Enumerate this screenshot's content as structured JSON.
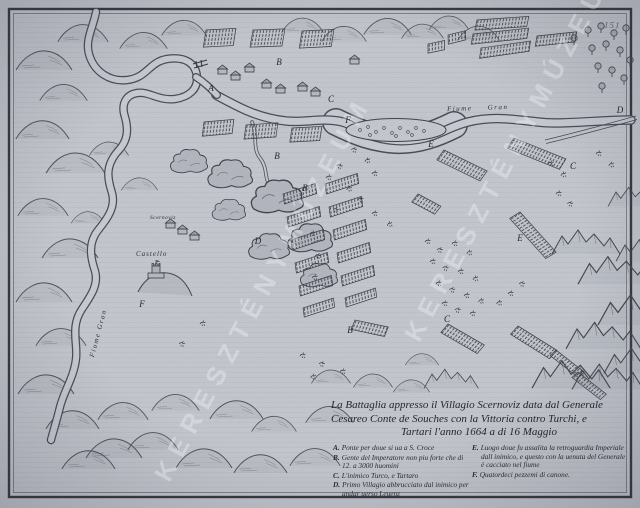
{
  "artifact": {
    "page_number": "151",
    "watermark_text": "KERESZTÉNYMÚZEUM"
  },
  "colors": {
    "paper": "#c2c6cd",
    "ink": "#3a3a42",
    "water": "#c9ccd4",
    "smoke": "#b4b7c0"
  },
  "title": {
    "line1": "La Battaglia appresso il Villagio Scernoviz data dal Generale",
    "line2": "Cesareo Conte de Souches con la Vittoria contro Turchi, e",
    "line3": "Tartari l'anno 1664 a di 16 Maggio"
  },
  "legend": {
    "left": [
      {
        "key": "A.",
        "text": "Ponte per doue si ua a S. Croce"
      },
      {
        "key": "B.",
        "text": "Gente del Imperatore non piu forte che di 12. a 3000 huomini"
      },
      {
        "key": "C.",
        "text": "L'inimico Turco, e Tartaro"
      },
      {
        "key": "D.",
        "text": "Primo Villagio abbrucciato dal inimico per andar uerso Leuenz"
      }
    ],
    "right": [
      {
        "key": "E.",
        "text": "Luogo doue fu assalita la retroguardia Imperiale dall inimico, e questo con la uenuta del Generale è cacciato nel fiume"
      },
      {
        "key": "F.",
        "text": "Quatordeci pezzemi di canone."
      }
    ]
  },
  "map_labels": {
    "river_main": "Fiume Gran",
    "river_left": "Fiume Gran",
    "castle": "Castello",
    "village": "Scernoviz"
  },
  "markers": [
    {
      "ch": "A",
      "x": 211,
      "y": 88
    },
    {
      "ch": "B",
      "x": 279,
      "y": 62
    },
    {
      "ch": "B",
      "x": 277,
      "y": 156
    },
    {
      "ch": "C",
      "x": 331,
      "y": 99
    },
    {
      "ch": "F",
      "x": 348,
      "y": 120
    },
    {
      "ch": "C",
      "x": 573,
      "y": 166
    },
    {
      "ch": "B",
      "x": 305,
      "y": 188
    },
    {
      "ch": "E",
      "x": 431,
      "y": 144
    },
    {
      "ch": "E",
      "x": 520,
      "y": 238
    },
    {
      "ch": "B",
      "x": 350,
      "y": 330
    },
    {
      "ch": "C",
      "x": 447,
      "y": 319
    },
    {
      "ch": "D",
      "x": 258,
      "y": 241
    },
    {
      "ch": "F",
      "x": 142,
      "y": 304
    },
    {
      "ch": "D",
      "x": 620,
      "y": 110
    }
  ]
}
